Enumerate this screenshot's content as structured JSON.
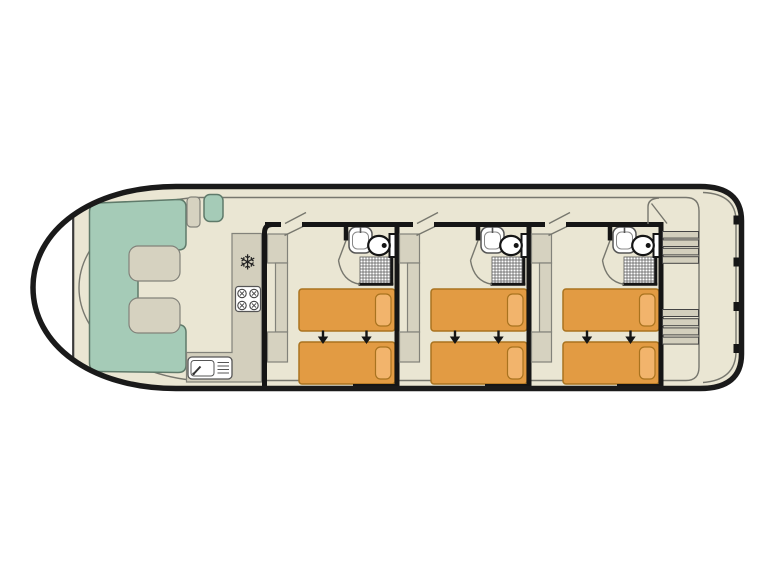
{
  "plan": {
    "type": "boat-deck-floor-plan",
    "cabins": 3,
    "beds_per_cabin": 2,
    "bathrooms_per_cabin": 1,
    "bed_join_arrows_per_cabin": 2,
    "bow_lounge": {
      "u_shaped_seating": 1,
      "tables": 2
    },
    "galley": {
      "refrigerator": 1,
      "hob_burners": 4,
      "sink_with_drainer": 1
    },
    "stern": {
      "step_flights": 2,
      "steps_per_flight": 4
    }
  },
  "glyphs": {
    "snowflake": "❄"
  },
  "colors": {
    "page-bg": "#ffffff",
    "hull-line": "#1a1a1a",
    "wall": "#151515",
    "floor": "#eae6d3",
    "seating": "#a5cbb7",
    "seating-stroke": "#5f7a6a",
    "furniture": "#d6d2c0",
    "furniture-stroke": "#82827a",
    "counter": "#d3cfbd",
    "bed": "#e29b43",
    "bed-stroke": "#a9731f",
    "pillow": "#f2b46c",
    "thin-line": "#77776e",
    "fixture-stroke": "#555555",
    "white": "#ffffff",
    "bow-chord-line": "#3a3a3a"
  }
}
